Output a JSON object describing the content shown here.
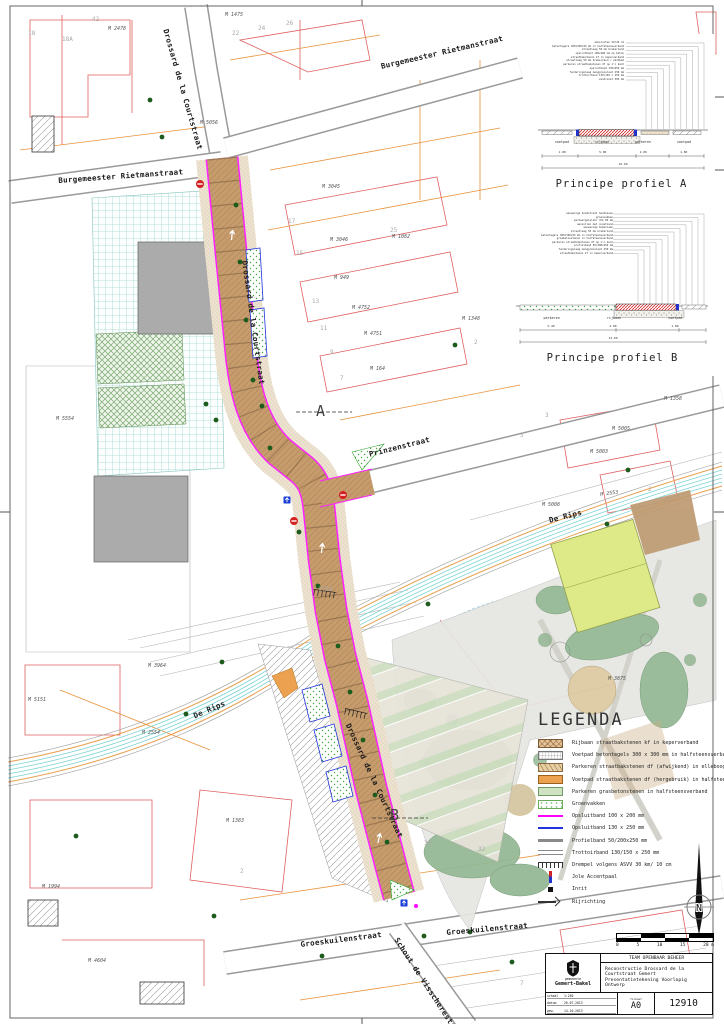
{
  "colors": {
    "road_brown": "#c69c6d",
    "opsluitband_magenta": "#ff00ff",
    "opsluitband_blue": "#2233dd",
    "water_cyan": "#7fd4d4",
    "cadastral_red": "#e06060",
    "cadastral_orange": "#e8923a"
  },
  "profiles": {
    "a": {
      "caption": "Principe profiel A",
      "callouts": [
        "aansluiten 50/20 cm",
        "betontegels 300x300x45 mm in halfsteensverband",
        "straatlaag 50 mm brekerzand",
        "opsluitband 100x200 mm op beton",
        "straatbakstenen kf in keperverband",
        "straatlaag 50 mm brekerzand / zandbed",
        "parkeren straatbakstenen df op z'n kant",
        "opsluitband 130x250 mm",
        "funderingslaag menggranulaat 250 mm",
        "trottoirband 130/150 x 250 mm",
        "zandcunet 500 mm"
      ],
      "zones": [
        "voetpad",
        "rijbaan",
        "parkeren",
        "voetpad"
      ],
      "dims": [
        "1.80",
        "5.00",
        "2.00",
        "1.80"
      ],
      "total": "10.60"
    },
    "b": {
      "caption": "Principe profiel B",
      "callouts": [
        "aanwezige boomstraat handhaven",
        "groenvakken",
        "parkeergeleider dik 80 mm",
        "aanvullen met cunetzand",
        "aanwezige bomenlaan",
        "straatlaag 50 mm brekerzand",
        "betontegels 300x300x45 mm in halfsteensverband",
        "grasbetonstenen in halfsteensverband",
        "parkeren straatbakstenen df op z'n kant",
        "profielband 50/200x250 mm",
        "funderingslaag menggranulaat 250 mm",
        "straatbakstenen kf in keperverband"
      ],
      "zones": [
        "parkeren",
        "rijbaan",
        "voetpad"
      ],
      "dims": [
        "5.40",
        "4.80",
        "1.80"
      ],
      "total": "12.00"
    }
  },
  "legend": {
    "title": "LEGENDA",
    "items": [
      {
        "label": "Rijbaan straatbakstenen kf in keperverband",
        "swatch": "rijbaan"
      },
      {
        "label": "Voetpad betontegels 300 x 300 mm in halfsteensverband",
        "swatch": "tegels"
      },
      {
        "label": "Parkeren straatbakstenen df (afwijkend) in elleboogverband",
        "swatch": "parkdf"
      },
      {
        "label": "Voetpad straatbakstenen df (hergebruik) in halfsteensverband",
        "swatch": "voetdf"
      },
      {
        "label": "Parkeren grasbetonstenen in halfsteensverband",
        "swatch": "gras"
      },
      {
        "label": "Groenvakken",
        "swatch": "groen"
      },
      {
        "label": "Opsluitband 100 x 200 mm",
        "swatch": "ops100"
      },
      {
        "label": "Opsluitband 130 x 250 mm",
        "swatch": "ops130"
      },
      {
        "label": "Profielband 50/200x250 mm",
        "swatch": "profb"
      },
      {
        "label": "Trottoirband 130/150 x 250 mm",
        "swatch": "trot"
      },
      {
        "label": "Drempel volgens ASVV 30 km/ 10 cm",
        "swatch": "drempel"
      },
      {
        "label": "Jole Accentpaal",
        "swatch": "paal"
      },
      {
        "label": "Inrit",
        "swatch": "inrit"
      },
      {
        "label": "Rijrichting",
        "swatch": "arrow"
      }
    ]
  },
  "scalebar": {
    "labels": [
      "0",
      "5",
      "10",
      "15",
      "20 m"
    ]
  },
  "north": {
    "label": "N"
  },
  "titleblock": {
    "department": "TEAM OPENBAAR BEHEER",
    "project": "Reconstructie Drossard de la Courtstraat Gemert",
    "subtitle": "Presentatietekening Voorlopig Ontwerp",
    "municipality_small": "gemeente",
    "municipality": "Gemert-Bakel",
    "fields": [
      {
        "k": "schaal",
        "v": "1:250"
      },
      {
        "k": "datum",
        "v": "26-07-2013"
      },
      {
        "k": "gew.",
        "v": "14-10-2013"
      }
    ],
    "format_label": "formaat",
    "format": "A0",
    "number": "12910"
  },
  "map": {
    "street_labels": [
      {
        "text": "Drossard de la Courtstraat",
        "x": 170,
        "y": 28,
        "rot": 74
      },
      {
        "text": "Drossard de la Courtstraat",
        "x": 249,
        "y": 260,
        "rot": 82
      },
      {
        "text": "Drossard de la Courtstraat",
        "x": 352,
        "y": 722,
        "rot": 65
      },
      {
        "text": "Burgemeester Rietmanstraat",
        "x": 58,
        "y": 176,
        "rot": -4
      },
      {
        "text": "Burgemeester Rietmanstraat",
        "x": 380,
        "y": 62,
        "rot": -13
      },
      {
        "text": "Prinzenstraat",
        "x": 368,
        "y": 450,
        "rot": -14
      },
      {
        "text": "De Rips",
        "x": 192,
        "y": 712,
        "rot": -23
      },
      {
        "text": "De Rips",
        "x": 548,
        "y": 516,
        "rot": -14
      },
      {
        "text": "Groeskuilenstraat",
        "x": 300,
        "y": 940,
        "rot": -7
      },
      {
        "text": "Groeskuilenstraat",
        "x": 446,
        "y": 928,
        "rot": -5
      },
      {
        "text": "Schout de Visscherestraat",
        "x": 400,
        "y": 936,
        "rot": 57
      }
    ],
    "parcel_labels": [
      {
        "text": "M 2478",
        "x": 108,
        "y": 26
      },
      {
        "text": "M 1475",
        "x": 225,
        "y": 12
      },
      {
        "text": "M 5056",
        "x": 200,
        "y": 120
      },
      {
        "text": "M 3045",
        "x": 322,
        "y": 184
      },
      {
        "text": "M 3046",
        "x": 330,
        "y": 237
      },
      {
        "text": "M 1082",
        "x": 392,
        "y": 234
      },
      {
        "text": "M 949",
        "x": 334,
        "y": 275
      },
      {
        "text": "M 4752",
        "x": 352,
        "y": 305
      },
      {
        "text": "M 4751",
        "x": 364,
        "y": 331
      },
      {
        "text": "M 164",
        "x": 370,
        "y": 366
      },
      {
        "text": "M 1348",
        "x": 462,
        "y": 316
      },
      {
        "text": "M 1358",
        "x": 664,
        "y": 396
      },
      {
        "text": "M 5005",
        "x": 612,
        "y": 426
      },
      {
        "text": "M 5003",
        "x": 590,
        "y": 449
      },
      {
        "text": "M 5008",
        "x": 542,
        "y": 502
      },
      {
        "text": "M 2553",
        "x": 600,
        "y": 492,
        "rot": -8
      },
      {
        "text": "M 3875",
        "x": 608,
        "y": 676
      },
      {
        "text": "M 3964",
        "x": 148,
        "y": 663
      },
      {
        "text": "M 5151",
        "x": 28,
        "y": 697
      },
      {
        "text": "M 2554",
        "x": 142,
        "y": 730
      },
      {
        "text": "M 1383",
        "x": 226,
        "y": 818
      },
      {
        "text": "M 1994",
        "x": 42,
        "y": 884
      },
      {
        "text": "M 4604",
        "x": 88,
        "y": 958
      },
      {
        "text": "M 5554",
        "x": 56,
        "y": 416
      }
    ],
    "house_numbers": [
      {
        "text": "18",
        "x": 28,
        "y": 30
      },
      {
        "text": "18A",
        "x": 62,
        "y": 36
      },
      {
        "text": "42",
        "x": 92,
        "y": 16
      },
      {
        "text": "22",
        "x": 232,
        "y": 30
      },
      {
        "text": "24",
        "x": 258,
        "y": 25
      },
      {
        "text": "26",
        "x": 286,
        "y": 20
      },
      {
        "text": "17",
        "x": 288,
        "y": 218
      },
      {
        "text": "15",
        "x": 296,
        "y": 250
      },
      {
        "text": "13",
        "x": 312,
        "y": 298
      },
      {
        "text": "11",
        "x": 320,
        "y": 325
      },
      {
        "text": "9",
        "x": 330,
        "y": 349
      },
      {
        "text": "7",
        "x": 340,
        "y": 375
      },
      {
        "text": "25",
        "x": 390,
        "y": 227
      },
      {
        "text": "2",
        "x": 474,
        "y": 339
      },
      {
        "text": "5",
        "x": 520,
        "y": 432
      },
      {
        "text": "3",
        "x": 545,
        "y": 412
      },
      {
        "text": "1732",
        "x": 318,
        "y": 586
      },
      {
        "text": "2",
        "x": 240,
        "y": 868
      },
      {
        "text": "30",
        "x": 424,
        "y": 840
      },
      {
        "text": "32",
        "x": 478,
        "y": 846
      },
      {
        "text": "2",
        "x": 648,
        "y": 486
      },
      {
        "text": "7",
        "x": 520,
        "y": 980
      }
    ],
    "section_markers": [
      {
        "text": "A",
        "x": 316,
        "y": 402
      },
      {
        "text": "B",
        "x": 390,
        "y": 806
      }
    ]
  }
}
